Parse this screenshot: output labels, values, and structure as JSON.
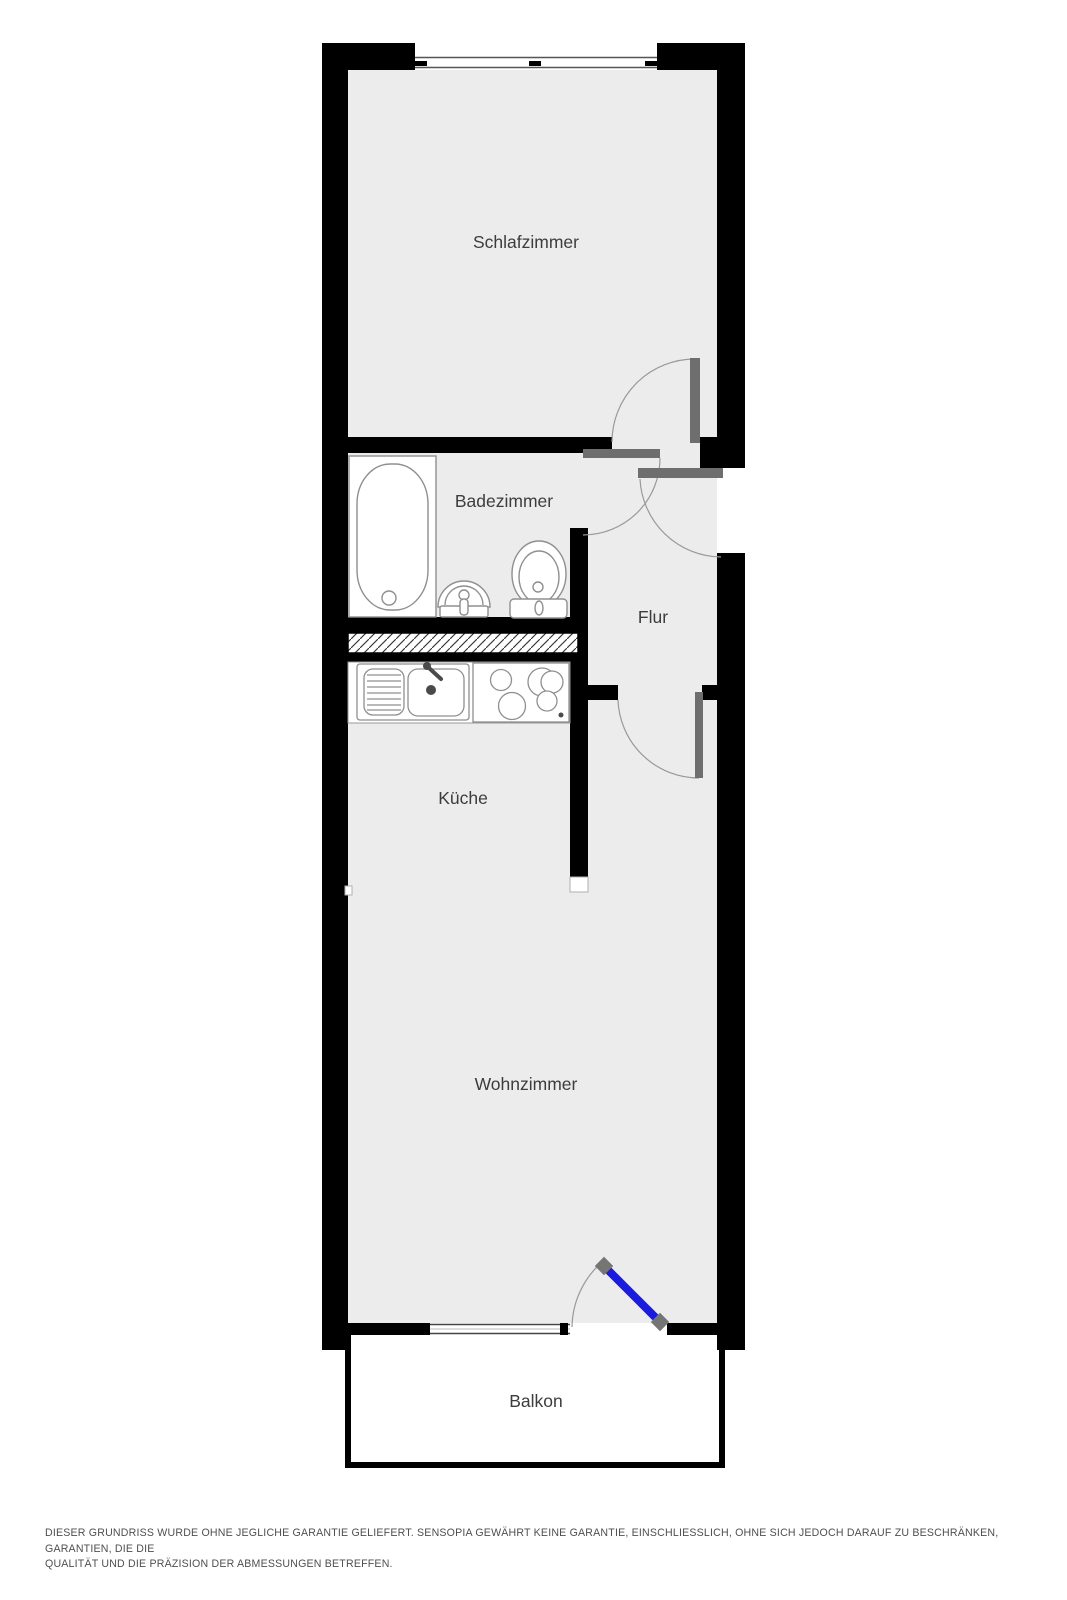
{
  "rooms": {
    "schlafzimmer": {
      "label": "Schlafzimmer"
    },
    "badezimmer": {
      "label": "Badezimmer"
    },
    "flur": {
      "label": "Flur"
    },
    "kueche": {
      "label": "Küche"
    },
    "wohnzimmer": {
      "label": "Wohnzimmer"
    },
    "balkon": {
      "label": "Balkon"
    }
  },
  "disclaimer": {
    "line1": "DIESER GRUNDRISS WURDE OHNE JEGLICHE GARANTIE GELIEFERT. SENSOPIA GEWÄHRT KEINE GARANTIE, EINSCHLIESSLICH, OHNE SICH JEDOCH DARAUF ZU BESCHRÄNKEN, GARANTIEN, DIE DIE",
    "line2": "QUALITÄT UND DIE PRÄZISION DER ABMESSUNGEN BETREFFEN."
  },
  "colors": {
    "wall": "#000000",
    "room_fill": "#ececec",
    "door_leaf": "#6e6e6e",
    "door_arc": "#999999",
    "fixture_stroke": "#8f8f8f",
    "balcony_door_blue": "#1b1be0",
    "hinge_cap_gray": "#757575",
    "label_text": "#3d3d3d",
    "disclaimer_text": "#4f4f4f"
  }
}
